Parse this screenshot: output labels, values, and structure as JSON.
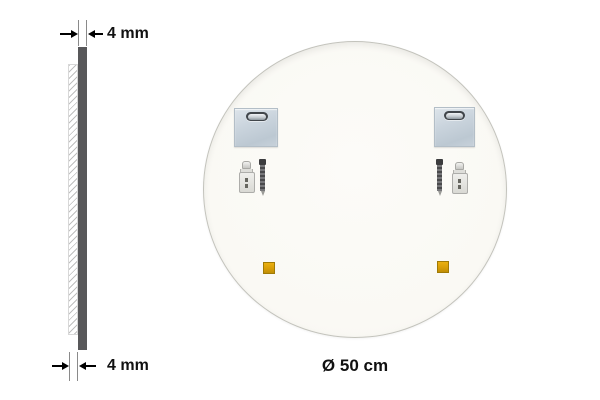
{
  "side_view": {
    "top_dimension_label": "4 mm",
    "bottom_dimension_label": "4 mm",
    "glass_edge_color": "#58585a"
  },
  "back_view": {
    "diameter_label": "Ø 50 cm",
    "surface_color": "#faf9f4",
    "hardware": {
      "mounting_plate_count": 2,
      "mounting_plate_color": "#c7d2db",
      "wall_anchor_count": 2,
      "screw_count": 2,
      "adhesive_pad_count": 2,
      "adhesive_pad_color": "#d99e07"
    }
  }
}
